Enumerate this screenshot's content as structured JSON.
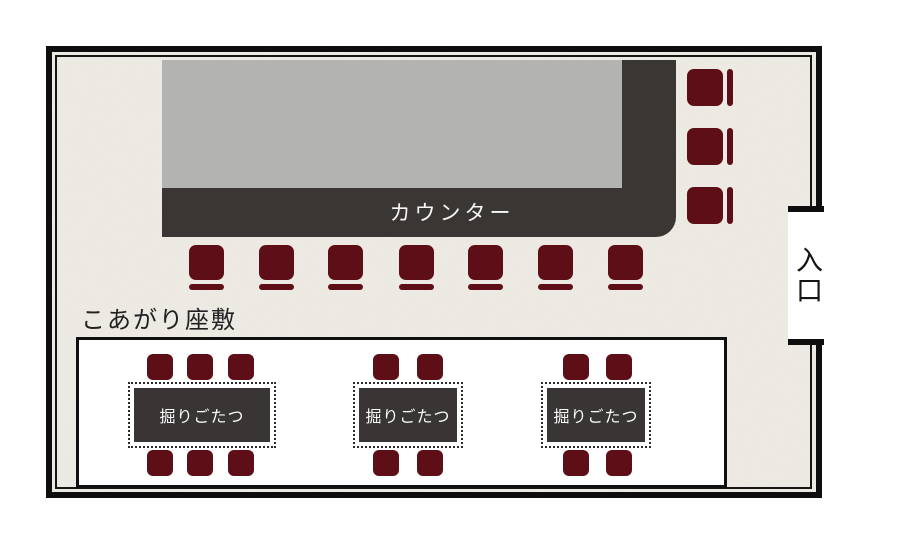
{
  "plan": {
    "kind": "restaurant-floor-plan",
    "colors": {
      "paper": "#f1eee8",
      "frame": "#0e0e0e",
      "counter_surface": "#b3b3b1",
      "counter_base": "#3a3634",
      "seat": "#5e0e16",
      "table_top": "#393534",
      "zashiki_bg": "#ffffff"
    },
    "counter": {
      "label": "カウンター",
      "stools_bottom_count": 7,
      "stools_right_count": 3
    },
    "zashiki": {
      "label": "こあがり座敷",
      "tables": [
        {
          "label": "掘りごたつ",
          "seats_top": 3,
          "seats_bottom": 3
        },
        {
          "label": "掘りごたつ",
          "seats_top": 2,
          "seats_bottom": 2
        },
        {
          "label": "掘りごたつ",
          "seats_top": 2,
          "seats_bottom": 2
        }
      ]
    },
    "entrance": {
      "label": "入口"
    }
  }
}
